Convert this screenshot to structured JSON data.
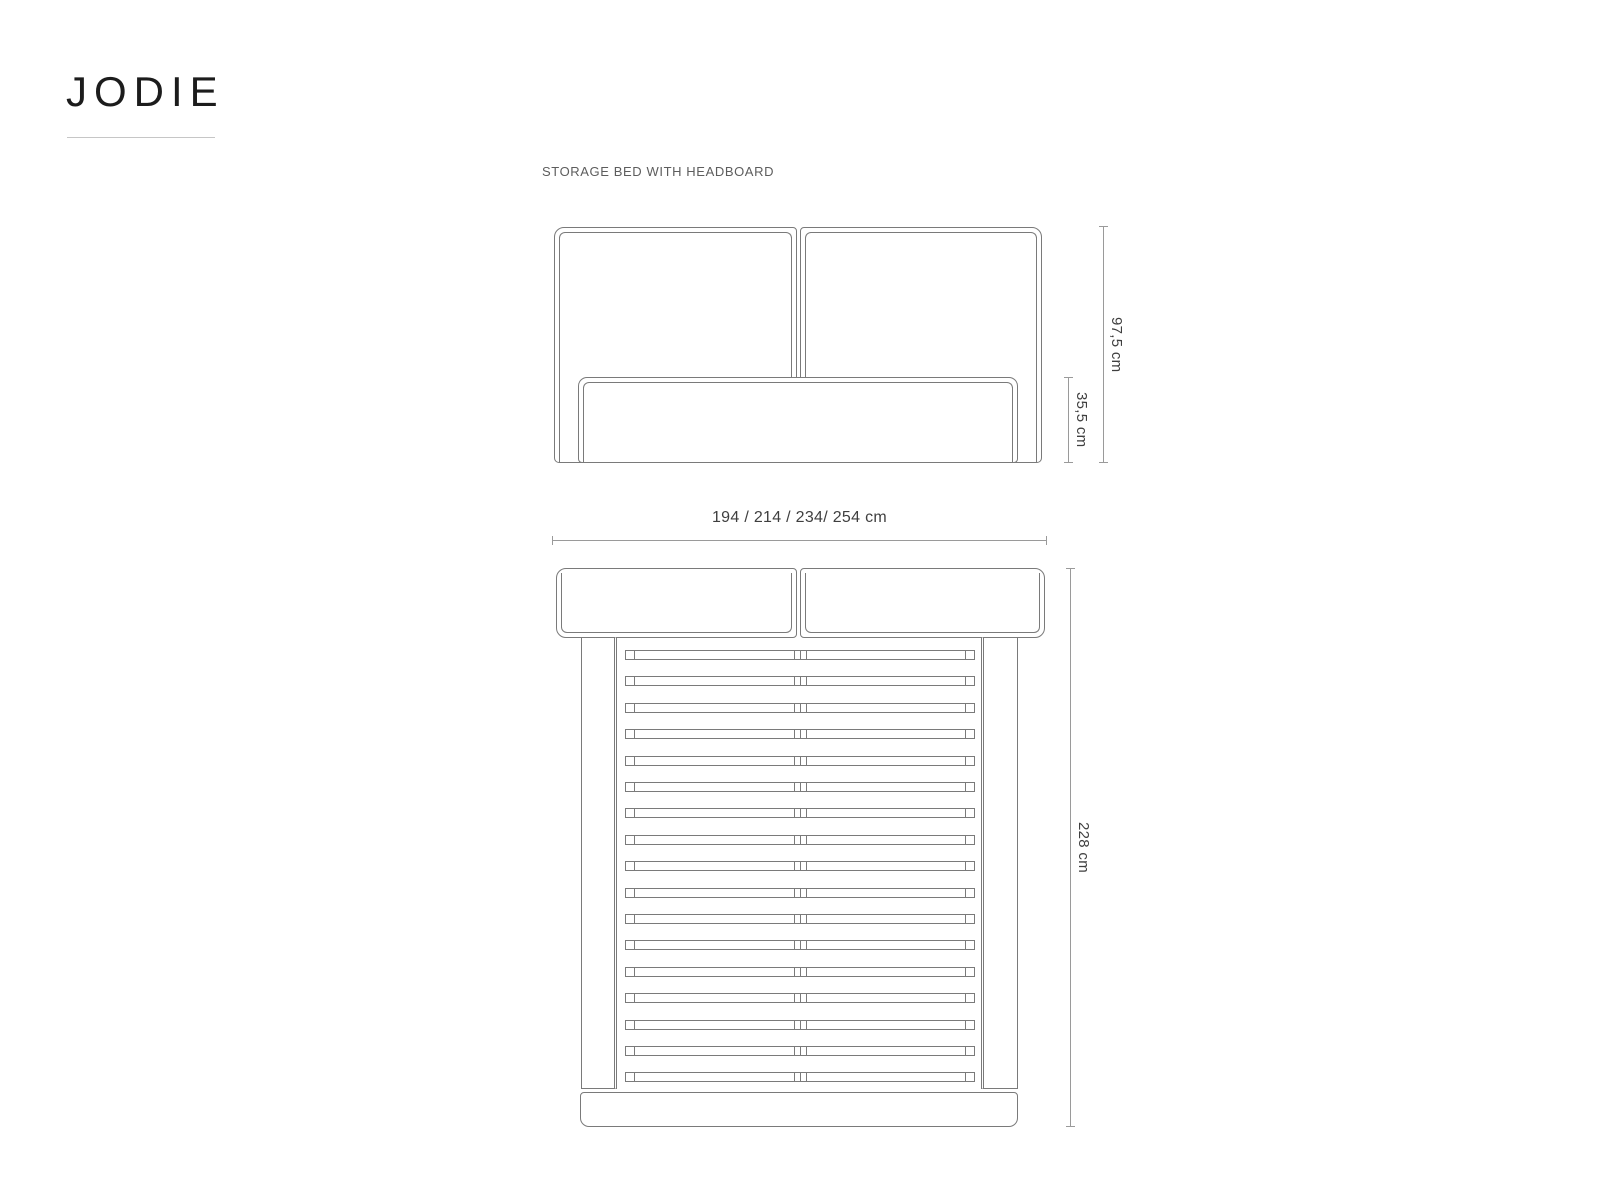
{
  "title": "JODIE",
  "subtitle": "STORAGE BED WITH HEADBOARD",
  "front_view": {
    "dim_total_height": "97,5 cm",
    "dim_base_height": "35,5 cm"
  },
  "top_view": {
    "dim_width": "194 / 214 / 234/ 254 cm",
    "dim_length": "228 cm",
    "slat_count": 17
  },
  "colors": {
    "drawing_line": "#7a7a7a",
    "dimension_line": "#9a9a9a",
    "dimension_text": "#3f3f3f",
    "title_text": "#1c1c1c",
    "subtitle_text": "#5d5d5d",
    "background": "#ffffff"
  }
}
